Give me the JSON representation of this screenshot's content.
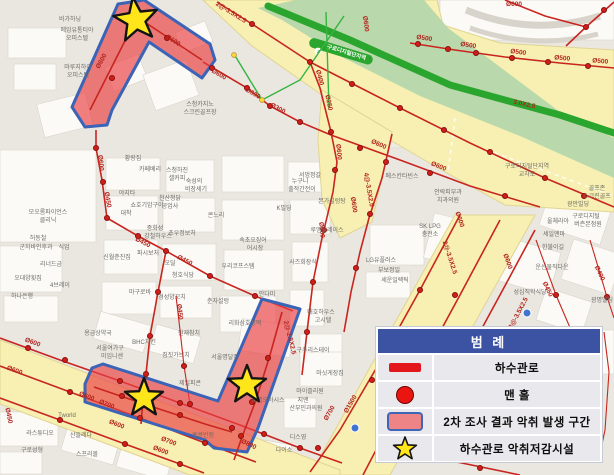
{
  "legend": {
    "title": "범 례",
    "items": [
      {
        "icon": "sewer-pipe-line-icon",
        "label": "하수관로"
      },
      {
        "icon": "manhole-icon",
        "label": "맨 홀"
      },
      {
        "icon": "odor-zone-icon",
        "label": "2차 조사 결과 악취 발생 구간"
      },
      {
        "icon": "odor-reduction-facility-star-icon",
        "label": "하수관로 악취저감시설"
      }
    ]
  },
  "map": {
    "station": {
      "line_badge": "2",
      "name": "구로디지털단지역"
    },
    "colors": {
      "pipe_red": "#c9251f",
      "zone_fill": "#ee6f71",
      "zone_border": "#3b63b6",
      "road_yellow": "#f7f0b2",
      "subway_green": "#2aa62e",
      "star_yellow": "#ffe61a",
      "legend_header_blue": "#3c53a4"
    },
    "stars": [
      {
        "x": 136,
        "y": 20,
        "r": 23,
        "rot": -8
      },
      {
        "x": 144,
        "y": 398,
        "r": 20,
        "rot": 0
      },
      {
        "x": 247,
        "y": 385,
        "r": 20,
        "rot": 0
      }
    ],
    "pipe_labels": [
      {
        "t": "Ø600",
        "x": 103,
        "y": 62,
        "r": -62
      },
      {
        "t": "Ø600",
        "x": 172,
        "y": 42,
        "r": 33
      },
      {
        "t": "Ø600",
        "x": 218,
        "y": 76,
        "r": 30
      },
      {
        "t": "Ø600",
        "x": 252,
        "y": 95,
        "r": 30
      },
      {
        "t": "Ø300",
        "x": 277,
        "y": 110,
        "r": 28
      },
      {
        "t": "2@-3.5X2.5",
        "x": 230,
        "y": 14,
        "r": 32
      },
      {
        "t": "Ø400",
        "x": 318,
        "y": 78,
        "r": 75
      },
      {
        "t": "Ø250",
        "x": 327,
        "y": 103,
        "r": 78
      },
      {
        "t": "Ø500",
        "x": 424,
        "y": 40,
        "r": 8
      },
      {
        "t": "Ø500",
        "x": 468,
        "y": 47,
        "r": 8
      },
      {
        "t": "Ø500",
        "x": 518,
        "y": 54,
        "r": 7
      },
      {
        "t": "Ø500",
        "x": 562,
        "y": 60,
        "r": 5
      },
      {
        "t": "Ø500",
        "x": 600,
        "y": 63,
        "r": 5
      },
      {
        "t": "Ø600",
        "x": 514,
        "y": 6,
        "r": 0
      },
      {
        "t": "Ø600",
        "x": 364,
        "y": 24,
        "r": 83
      },
      {
        "t": "3.0X2.5",
        "x": 524,
        "y": 106,
        "r": 12
      },
      {
        "t": "Ø600",
        "x": 337,
        "y": 152,
        "r": 85
      },
      {
        "t": "Ø600",
        "x": 320,
        "y": 230,
        "r": 85
      },
      {
        "t": "4@-3.5X2.5",
        "x": 367,
        "y": 190,
        "r": 80
      },
      {
        "t": "Ø600",
        "x": 352,
        "y": 205,
        "r": 82
      },
      {
        "t": "2@-3.5X2.5",
        "x": 448,
        "y": 258,
        "r": 72
      },
      {
        "t": "Ø600",
        "x": 458,
        "y": 220,
        "r": 72
      },
      {
        "t": "Ø600",
        "x": 506,
        "y": 262,
        "r": 70
      },
      {
        "t": "Ø600",
        "x": 99,
        "y": 163,
        "r": 85
      },
      {
        "t": "Ø450",
        "x": 106,
        "y": 200,
        "r": 80
      },
      {
        "t": "Ø450",
        "x": 142,
        "y": 244,
        "r": 27
      },
      {
        "t": "Ø450",
        "x": 184,
        "y": 262,
        "r": 27
      },
      {
        "t": "Ø450",
        "x": 178,
        "y": 312,
        "r": 84
      },
      {
        "t": "Ø600",
        "x": 32,
        "y": 344,
        "r": 20
      },
      {
        "t": "Ø600",
        "x": 14,
        "y": 372,
        "r": 20
      },
      {
        "t": "Ø450",
        "x": 7,
        "y": 416,
        "r": 78
      },
      {
        "t": "Ø600",
        "x": 86,
        "y": 398,
        "r": 21
      },
      {
        "t": "Ø700",
        "x": 106,
        "y": 406,
        "r": 21
      },
      {
        "t": "Ø600",
        "x": 116,
        "y": 426,
        "r": 21
      },
      {
        "t": "Ø700",
        "x": 168,
        "y": 443,
        "r": 21
      },
      {
        "t": "Ø600",
        "x": 160,
        "y": 452,
        "r": 21
      },
      {
        "t": "2@-2.5X2.5",
        "x": 288,
        "y": 338,
        "r": 76
      },
      {
        "t": "Ø800",
        "x": 248,
        "y": 446,
        "r": 25
      },
      {
        "t": "Ø700",
        "x": 331,
        "y": 414,
        "r": -60
      },
      {
        "t": "Ø1500",
        "x": 352,
        "y": 405,
        "r": -60
      },
      {
        "t": "Ø450",
        "x": 546,
        "y": 290,
        "r": 65
      },
      {
        "t": "Ø400",
        "x": 598,
        "y": 274,
        "r": 65
      },
      {
        "t": "Ø600",
        "x": 378,
        "y": 146,
        "r": 24
      },
      {
        "t": "Ø600",
        "x": 438,
        "y": 168,
        "r": 22
      },
      {
        "t": "3@-3.5X2.5",
        "x": 520,
        "y": 314,
        "r": -62
      }
    ],
    "place_labels": [
      {
        "t": "비가하닝",
        "x": 70,
        "y": 21
      },
      {
        "t": "메잉유통티아",
        "x": 77,
        "y": 32
      },
      {
        "t": "오피스텔",
        "x": 77,
        "y": 40
      },
      {
        "t": "마루지하이",
        "x": 78,
        "y": 69
      },
      {
        "t": "오피스텔",
        "x": 78,
        "y": 77
      },
      {
        "t": "스청카지노",
        "x": 200,
        "y": 106
      },
      {
        "t": "스크린골프장",
        "x": 200,
        "y": 114
      },
      {
        "t": "대착",
        "x": 126,
        "y": 215
      },
      {
        "t": "황랑집",
        "x": 133,
        "y": 160
      },
      {
        "t": "카페베리",
        "x": 150,
        "y": 171
      },
      {
        "t": "스청하진",
        "x": 177,
        "y": 172
      },
      {
        "t": "셀커피",
        "x": 177,
        "y": 180
      },
      {
        "t": "숙성의",
        "x": 194,
        "y": 183
      },
      {
        "t": "비장세기",
        "x": 196,
        "y": 191
      },
      {
        "t": "야지타",
        "x": 127,
        "y": 195
      },
      {
        "t": "쇼호기암구이",
        "x": 147,
        "y": 207
      },
      {
        "t": "천산청닭",
        "x": 170,
        "y": 200
      },
      {
        "t": "공업사",
        "x": 170,
        "y": 208
      },
      {
        "t": "모오롬파이언스",
        "x": 48,
        "y": 214
      },
      {
        "t": "클리닉",
        "x": 48,
        "y": 222
      },
      {
        "t": "허동철",
        "x": 38,
        "y": 240
      },
      {
        "t": "군자바인후과",
        "x": 36,
        "y": 249
      },
      {
        "t": "식업",
        "x": 64,
        "y": 249
      },
      {
        "t": "리너드금",
        "x": 51,
        "y": 266
      },
      {
        "t": "오대양횟집",
        "x": 28,
        "y": 280
      },
      {
        "t": "4브레이",
        "x": 60,
        "y": 287
      },
      {
        "t": "하나은행",
        "x": 22,
        "y": 298
      },
      {
        "t": "콘느리",
        "x": 216,
        "y": 217
      },
      {
        "t": "누구니",
        "x": 300,
        "y": 183
      },
      {
        "t": "출작간전이",
        "x": 302,
        "y": 191
      },
      {
        "t": "서멍정갈",
        "x": 310,
        "y": 177
      },
      {
        "t": "본가설렁탕",
        "x": 332,
        "y": 203
      },
      {
        "t": "K빌딩",
        "x": 284,
        "y": 210
      },
      {
        "t": "루엠플레이스",
        "x": 327,
        "y": 232
      },
      {
        "t": "속초오징어",
        "x": 253,
        "y": 242
      },
      {
        "t": "어시장",
        "x": 255,
        "y": 250
      },
      {
        "t": "중화성",
        "x": 155,
        "y": 230
      },
      {
        "t": "강철하우스",
        "x": 158,
        "y": 238
      },
      {
        "t": "초우정보처",
        "x": 182,
        "y": 235
      },
      {
        "t": "신월춘진집",
        "x": 117,
        "y": 259
      },
      {
        "t": "파시보처",
        "x": 148,
        "y": 255
      },
      {
        "t": "우리코프스템",
        "x": 238,
        "y": 268
      },
      {
        "t": "사즈회장식",
        "x": 303,
        "y": 264
      },
      {
        "t": "안다미",
        "x": 267,
        "y": 296
      },
      {
        "t": "춘자설렁",
        "x": 218,
        "y": 303
      },
      {
        "t": "마구로바",
        "x": 140,
        "y": 294
      },
      {
        "t": "경성양꼬치",
        "x": 172,
        "y": 299
      },
      {
        "t": "청호식당",
        "x": 183,
        "y": 277
      },
      {
        "t": "오딜",
        "x": 170,
        "y": 265
      },
      {
        "t": "용금상약국",
        "x": 98,
        "y": 335
      },
      {
        "t": "서울여가구",
        "x": 110,
        "y": 350
      },
      {
        "t": "미임니센",
        "x": 112,
        "y": 358
      },
      {
        "t": "BHC치킨",
        "x": 144,
        "y": 344
      },
      {
        "t": "원재참치",
        "x": 189,
        "y": 335
      },
      {
        "t": "짐짓가브치",
        "x": 176,
        "y": 357
      },
      {
        "t": "제일피콘",
        "x": 190,
        "y": 385
      },
      {
        "t": "리화삼호상떡",
        "x": 245,
        "y": 325
      },
      {
        "t": "매호하우스",
        "x": 321,
        "y": 314
      },
      {
        "t": "고시텔",
        "x": 323,
        "y": 322
      },
      {
        "t": "구주리스테이",
        "x": 313,
        "y": 352
      },
      {
        "t": "마싯게장집",
        "x": 330,
        "y": 375
      },
      {
        "t": "마이즐리원",
        "x": 310,
        "y": 393
      },
      {
        "t": "지엔",
        "x": 303,
        "y": 402
      },
      {
        "t": "산부인과의원",
        "x": 306,
        "y": 410
      },
      {
        "t": "디스영",
        "x": 298,
        "y": 439
      },
      {
        "t": "다이소",
        "x": 284,
        "y": 452
      },
      {
        "t": "홍콩반점",
        "x": 203,
        "y": 437
      },
      {
        "t": "서울명달집",
        "x": 225,
        "y": 359
      },
      {
        "t": "호랩오아시스",
        "x": 268,
        "y": 402
      },
      {
        "t": "Tworld",
        "x": 67,
        "y": 417
      },
      {
        "t": "라스튜디오",
        "x": 40,
        "y": 435
      },
      {
        "t": "산들레다",
        "x": 81,
        "y": 437
      },
      {
        "t": "구로성형",
        "x": 32,
        "y": 452
      },
      {
        "t": "스프리몰",
        "x": 87,
        "y": 456
      },
      {
        "t": "메스칸타빈스",
        "x": 402,
        "y": 178
      },
      {
        "t": "안락피부과",
        "x": 448,
        "y": 194
      },
      {
        "t": "치과의원",
        "x": 448,
        "y": 202
      },
      {
        "t": "SK LPG",
        "x": 430,
        "y": 228
      },
      {
        "t": "충전소",
        "x": 430,
        "y": 236
      },
      {
        "t": "LG유플러스",
        "x": 381,
        "y": 262
      },
      {
        "t": "부보정일",
        "x": 389,
        "y": 272
      },
      {
        "t": "세운일렉틱",
        "x": 395,
        "y": 282
      },
      {
        "t": "성심직학식당",
        "x": 530,
        "y": 294
      },
      {
        "t": "골프존",
        "x": 597,
        "y": 190
      },
      {
        "t": "스크린골프",
        "x": 597,
        "y": 198
      },
      {
        "t": "광안빌딩",
        "x": 578,
        "y": 206
      },
      {
        "t": "울체라아",
        "x": 558,
        "y": 223
      },
      {
        "t": "구로디지털",
        "x": 586,
        "y": 218
      },
      {
        "t": "버츤본점원",
        "x": 588,
        "y": 226
      },
      {
        "t": "세일엔마",
        "x": 554,
        "y": 236
      },
      {
        "t": "한불이길",
        "x": 553,
        "y": 249
      },
      {
        "t": "운선물직다운",
        "x": 552,
        "y": 269
      },
      {
        "t": "광명빌딩",
        "x": 602,
        "y": 302
      },
      {
        "t": "구로디지털단지역",
        "x": 527,
        "y": 168
      },
      {
        "t": "교차로",
        "x": 527,
        "y": 176
      },
      {
        "t": "구로디지털단지역",
        "x": 346,
        "y": 54,
        "r": 17,
        "cls": "station"
      },
      {
        "t": "2",
        "x": 318,
        "y": 53,
        "r": 17,
        "cls": "badge"
      }
    ],
    "manholes": [
      [
        418,
        44
      ],
      [
        448,
        49
      ],
      [
        476,
        53
      ],
      [
        512,
        58
      ],
      [
        548,
        62
      ],
      [
        588,
        66
      ],
      [
        604,
        10
      ],
      [
        586,
        27
      ],
      [
        252,
        24
      ],
      [
        310,
        62
      ],
      [
        352,
        84
      ],
      [
        400,
        108
      ],
      [
        444,
        130
      ],
      [
        490,
        152
      ],
      [
        545,
        178
      ],
      [
        584,
        196
      ],
      [
        212,
        68
      ],
      [
        247,
        88
      ],
      [
        270,
        106
      ],
      [
        300,
        122
      ],
      [
        331,
        132
      ],
      [
        335,
        170
      ],
      [
        324,
        230
      ],
      [
        313,
        282
      ],
      [
        307,
        332
      ],
      [
        386,
        162
      ],
      [
        370,
        214
      ],
      [
        356,
        268
      ],
      [
        360,
        148
      ],
      [
        430,
        173
      ],
      [
        505,
        196
      ],
      [
        96,
        148
      ],
      [
        103,
        182
      ],
      [
        107,
        218
      ],
      [
        138,
        236
      ],
      [
        166,
        251
      ],
      [
        210,
        276
      ],
      [
        255,
        296
      ],
      [
        158,
        292
      ],
      [
        150,
        336
      ],
      [
        146,
        374
      ],
      [
        122,
        396
      ],
      [
        180,
        415
      ],
      [
        268,
        358
      ],
      [
        252,
        402
      ],
      [
        241,
        436
      ],
      [
        28,
        348
      ],
      [
        65,
        360
      ],
      [
        120,
        381
      ],
      [
        180,
        403
      ],
      [
        232,
        428
      ],
      [
        264,
        434
      ],
      [
        300,
        448
      ],
      [
        70,
        392
      ],
      [
        140,
        418
      ],
      [
        205,
        443
      ],
      [
        60,
        420
      ],
      [
        125,
        444
      ],
      [
        180,
        464
      ],
      [
        184,
        366
      ],
      [
        190,
        404
      ],
      [
        420,
        290
      ],
      [
        372,
        380
      ],
      [
        318,
        448
      ],
      [
        455,
        295
      ],
      [
        410,
        373
      ],
      [
        556,
        295
      ],
      [
        607,
        297
      ],
      [
        480,
        468
      ],
      [
        167,
        38
      ],
      [
        112,
        78
      ]
    ]
  }
}
